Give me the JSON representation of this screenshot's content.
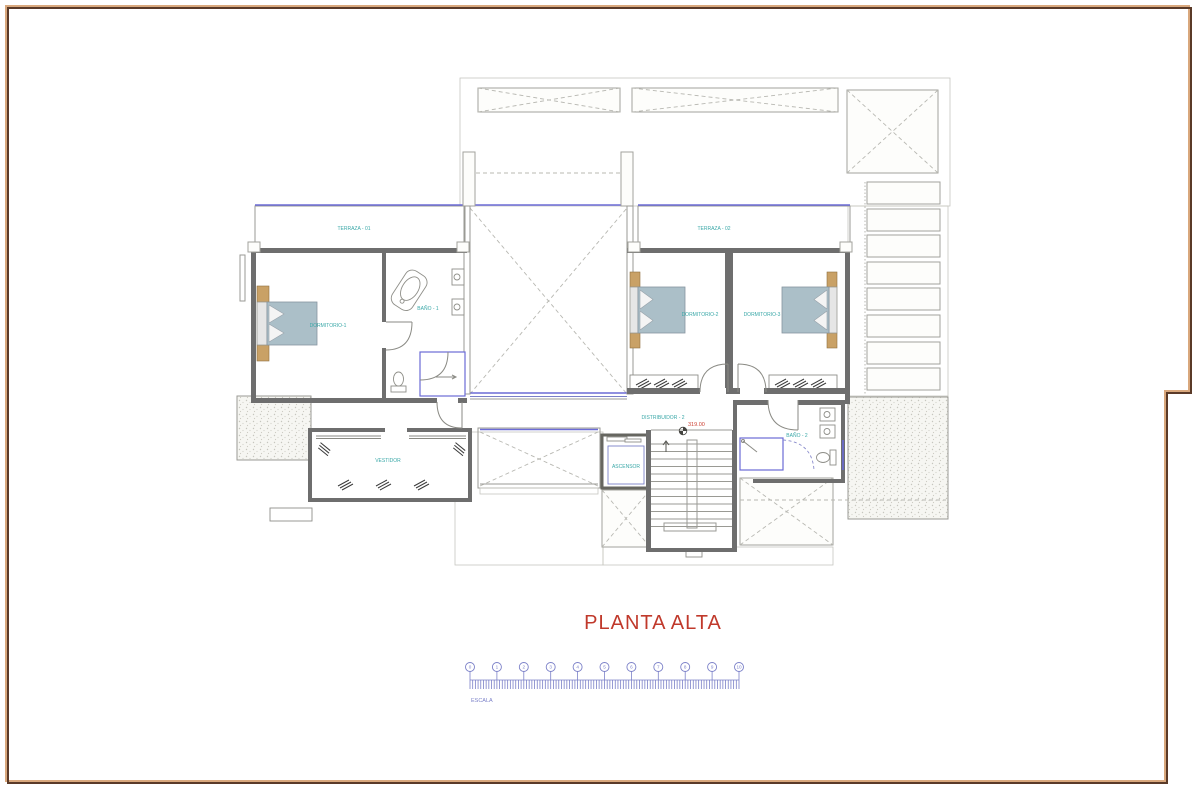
{
  "page": {
    "background": "#ffffff",
    "frame_color": "#5a3a28",
    "frame_accent_color": "#d9a87d"
  },
  "title": {
    "text": "PLANTA ALTA",
    "color": "#c0392b"
  },
  "labels": {
    "terraza1": "TERRAZA - 01",
    "terraza2": "TERRAZA - 02",
    "dormitorio1": "DORMITORIO-1",
    "bano1": "BAÑO - 1",
    "dormitorio2": "DORMITORIO-2",
    "dormitorio3": "DORMITORIO-3",
    "distribuidor2": "DISTRIBUIDOR - 2",
    "ascensor": "ASCENSOR",
    "bano2": "BAÑO - 2",
    "vestidor": "VESTIDOR",
    "level": "319.00"
  },
  "scale_bar": {
    "label": "ESCALA",
    "numbers": [
      "0",
      "1",
      "2",
      "3",
      "4",
      "5",
      "6",
      "7",
      "8",
      "9",
      "10"
    ],
    "color": "#7b80c8"
  },
  "colors": {
    "room_label": "#3aa8a8",
    "level_text": "#cc4033",
    "window_blue": "#6b6bd6",
    "wall_gray": "#6e6e6e",
    "deck_brown": "#a8805e"
  }
}
